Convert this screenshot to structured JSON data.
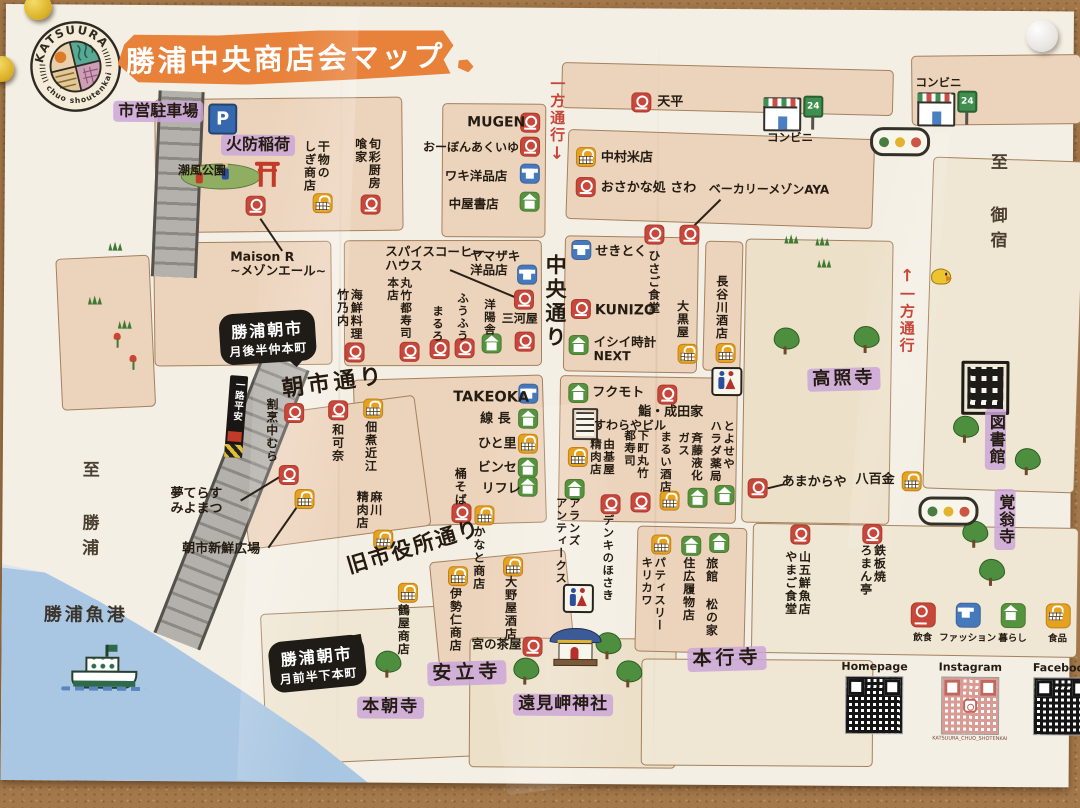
{
  "colors": {
    "red": "#c7473a",
    "blue": "#4579bd",
    "green": "#55943f",
    "yellow": "#e6a21f",
    "orange": "#e8813a",
    "purple": "#cba9d6",
    "oneway_red": "#bf3b2a"
  },
  "logo": {
    "arc_top": "KATSUURA",
    "arc_bottom": "chuo shoutenkai"
  },
  "title": "勝浦中央商店会マップ",
  "icons": {
    "parking": "P",
    "open24": "24"
  },
  "streets": [
    {
      "label": "朝市通り"
    },
    {
      "label": "旧市役所通り"
    },
    {
      "label": "中央通り"
    },
    {
      "label": "一方通行",
      "arrow": "↓"
    },
    {
      "label": "一方通行",
      "arrow": "↑"
    },
    {
      "label": "至 御宿"
    },
    {
      "label": "至 勝浦"
    },
    {
      "label": "勝浦魚港"
    },
    {
      "label": "一路平安"
    }
  ],
  "areas": [
    {
      "label": "市営駐車場"
    },
    {
      "label": "火防稲荷"
    },
    {
      "label": "潮風公園"
    },
    {
      "label": "高照寺"
    },
    {
      "label": "図書館"
    },
    {
      "label": "覚翁寺"
    },
    {
      "label": "本行寺"
    },
    {
      "label": "安立寺"
    },
    {
      "label": "本朝寺"
    },
    {
      "label": "遠見岬神社"
    }
  ],
  "bubbles": [
    {
      "lines": [
        "勝浦朝市",
        "月後半仲本町"
      ]
    },
    {
      "lines": [
        "勝浦朝市",
        "月前半下本町"
      ]
    }
  ],
  "legend": {
    "items": [
      {
        "type": "food",
        "label": "飲食"
      },
      {
        "type": "fashion",
        "label": "ファッション"
      },
      {
        "type": "living",
        "label": "暮らし"
      },
      {
        "type": "grocery",
        "label": "食品"
      }
    ]
  },
  "social": {
    "homepage": "Homepage",
    "instagram": "Instagram",
    "instagram_caption": "KATSUURA_CHUO_SHOTENKAI",
    "facebook": "Facebook"
  },
  "shops": [
    {
      "n": "干物の\nしぎ商店",
      "t": "grocery",
      "i": [
        308,
        187
      ],
      "l": [
        297,
        134
      ],
      "o": "v",
      "fs": 12
    },
    {
      "n": "旬彩厨房\n喰家",
      "t": "food",
      "i": [
        356,
        188
      ],
      "l": [
        348,
        131
      ],
      "o": "v",
      "fs": 12
    },
    {
      "n": "MUGEN",
      "t": "food",
      "i": [
        515,
        105
      ],
      "l": [
        462,
        108
      ],
      "o": "h",
      "fs": 14
    },
    {
      "n": "おーぼんあくいゆ",
      "t": "food",
      "i": [
        515,
        129
      ],
      "l": [
        418,
        134
      ],
      "o": "h",
      "fs": 12
    },
    {
      "n": "ワキ洋品店",
      "t": "fashion",
      "i": [
        515,
        156
      ],
      "l": [
        440,
        162
      ],
      "o": "h",
      "fs": 12.5
    },
    {
      "n": "中屋書店",
      "t": "living",
      "i": [
        515,
        184
      ],
      "l": [
        444,
        190
      ],
      "o": "h",
      "fs": 12.5
    },
    {
      "n": "天平",
      "t": "food",
      "i": [
        626,
        84
      ],
      "l": [
        652,
        87
      ],
      "o": "h",
      "fs": 13
    },
    {
      "n": "中村米店",
      "t": "grocery",
      "i": [
        571,
        139
      ],
      "l": [
        596,
        143
      ],
      "o": "h",
      "fs": 13
    },
    {
      "n": "おさかな処 さわ",
      "t": "food",
      "i": [
        571,
        169
      ],
      "l": [
        596,
        173
      ],
      "o": "h",
      "fs": 13
    },
    {
      "n": "コンビニ",
      "t": "store",
      "i": [
        758,
        88
      ],
      "l": [
        762,
        122
      ],
      "o": "h",
      "fs": 11.5
    },
    {
      "n": "コンビニ",
      "t": "store",
      "i": [
        912,
        82
      ],
      "l": [
        910,
        66
      ],
      "o": "h",
      "fs": 11.5
    },
    {
      "n": "せきとく",
      "t": "fashion",
      "i": [
        567,
        232
      ],
      "l": [
        591,
        237
      ],
      "o": "h",
      "fs": 13
    },
    {
      "n": "ひさご食堂",
      "t": "food",
      "i": [
        640,
        216
      ],
      "l": [
        642,
        241
      ],
      "o": "v",
      "fs": 12
    },
    {
      "n": "ベーカリーメゾンAYA",
      "t": "food",
      "i": [
        675,
        216
      ],
      "l": [
        704,
        174
      ],
      "o": "h",
      "fs": 12,
      "ln": [
        716,
        190,
        688,
        218
      ]
    },
    {
      "n": "長谷川酒店",
      "t": "grocery",
      "i": [
        712,
        334
      ],
      "l": [
        710,
        266
      ],
      "o": "v",
      "fs": 12
    },
    {
      "n": "KUNIZO",
      "t": "food",
      "i": [
        567,
        291
      ],
      "l": [
        591,
        295
      ],
      "o": "h",
      "fs": 14
    },
    {
      "n": "イシイ時計\nNEXT",
      "t": "living",
      "i": [
        565,
        327
      ],
      "l": [
        590,
        327
      ],
      "o": "h",
      "fs": 12.5
    },
    {
      "n": "大黒屋",
      "t": "grocery",
      "i": [
        674,
        335
      ],
      "l": [
        671,
        291
      ],
      "o": "v",
      "fs": 12
    },
    {
      "n": "海鮮料理\n竹乃内",
      "t": "food",
      "i": [
        341,
        336
      ],
      "l": [
        331,
        282
      ],
      "o": "v",
      "fs": 12
    },
    {
      "n": "スパイスコーヒー\nハウス",
      "t": "food",
      "i": [
        510,
        282
      ],
      "l": [
        381,
        238
      ],
      "o": "h",
      "fs": 12.5,
      "ln": [
        446,
        262,
        512,
        289
      ]
    },
    {
      "n": "ヤマザキ\n洋品店",
      "t": "fashion",
      "i": [
        513,
        257
      ],
      "l": [
        466,
        242
      ],
      "o": "h",
      "fs": 12.5
    },
    {
      "n": "丸竹都寿司\n本店",
      "t": "food",
      "i": [
        396,
        335
      ],
      "l": [
        382,
        270
      ],
      "o": "v",
      "fs": 11.5
    },
    {
      "n": "まるろ",
      "t": "food",
      "i": [
        426,
        332
      ],
      "l": [
        427,
        298
      ],
      "o": "v",
      "fs": 11.5
    },
    {
      "n": "ふうふう",
      "t": "food",
      "i": [
        451,
        331
      ],
      "l": [
        452,
        285
      ],
      "o": "v",
      "fs": 11.5
    },
    {
      "n": "洋陽舎",
      "t": "living",
      "i": [
        478,
        326
      ],
      "l": [
        479,
        291
      ],
      "o": "v",
      "fs": 11.5
    },
    {
      "n": "三河屋",
      "t": "food",
      "i": [
        511,
        324
      ],
      "l": [
        498,
        305
      ],
      "o": "h",
      "fs": 12
    },
    {
      "n": "TAKEOKA",
      "t": "fashion",
      "i": [
        515,
        376
      ],
      "l": [
        450,
        382
      ],
      "o": "h",
      "fs": 14.5
    },
    {
      "n": "線 長",
      "t": "living",
      "i": [
        515,
        401
      ],
      "l": [
        477,
        405
      ],
      "o": "h",
      "fs": 13
    },
    {
      "n": "ひと里",
      "t": "grocery",
      "i": [
        515,
        426
      ],
      "l": [
        475,
        430
      ],
      "o": "h",
      "fs": 13
    },
    {
      "n": "ビンセ",
      "t": "living",
      "i": [
        515,
        450
      ],
      "l": [
        475,
        454
      ],
      "o": "h",
      "fs": 13
    },
    {
      "n": "リフレ",
      "t": "living",
      "i": [
        515,
        469
      ],
      "l": [
        479,
        475
      ],
      "o": "h",
      "fs": 13
    },
    {
      "n": "桶そば",
      "t": "food",
      "i": [
        449,
        496
      ],
      "l": [
        450,
        460
      ],
      "o": "v",
      "fs": 12
    },
    {
      "n": "かなと商店",
      "t": "grocery",
      "i": [
        472,
        498
      ],
      "l": [
        469,
        518
      ],
      "o": "v",
      "fs": 12
    },
    {
      "n": "フクモト",
      "t": "living",
      "i": [
        565,
        375
      ],
      "l": [
        589,
        378
      ],
      "o": "h",
      "fs": 13
    },
    {
      "n": "鮨・成田家",
      "t": "food",
      "i": [
        654,
        376
      ],
      "l": [
        635,
        397
      ],
      "o": "h",
      "fs": 13
    },
    {
      "n": "すわらやビル",
      "t": "building",
      "i": [
        569,
        400
      ],
      "l": [
        591,
        411
      ],
      "o": "h",
      "fs": 12
    },
    {
      "n": "由基屋\n精肉店",
      "t": "grocery",
      "i": [
        565,
        439
      ],
      "l": [
        586,
        430
      ],
      "o": "v",
      "fs": 11.5
    },
    {
      "n": "下町丸竹\n都寿司",
      "t": "food",
      "i": [
        628,
        484
      ],
      "l": [
        620,
        421
      ],
      "o": "v",
      "fs": 11.5
    },
    {
      "n": "まるい酒店",
      "t": "grocery",
      "i": [
        657,
        482
      ],
      "l": [
        656,
        422
      ],
      "o": "v",
      "fs": 11.5
    },
    {
      "n": "斉藤液化\nガス",
      "t": "living",
      "i": [
        685,
        479
      ],
      "l": [
        674,
        423
      ],
      "o": "v",
      "fs": 11.5
    },
    {
      "n": "とよせや\nハラダ薬局",
      "t": "living",
      "i": [
        712,
        476
      ],
      "l": [
        706,
        411
      ],
      "o": "v",
      "fs": 11.5
    },
    {
      "n": "アランズ\nアンティークス",
      "t": "living",
      "i": [
        562,
        471
      ],
      "l": [
        552,
        489
      ],
      "o": "v",
      "fs": 11.5
    },
    {
      "n": "デンキのほさき",
      "t": "food",
      "i": [
        598,
        486
      ],
      "l": [
        599,
        506
      ],
      "o": "v",
      "fs": 11.5
    },
    {
      "n": "あまからや",
      "t": "food",
      "i": [
        745,
        469
      ],
      "l": [
        779,
        466
      ],
      "o": "h",
      "fs": 13,
      "ln": [
        765,
        478,
        781,
        474
      ]
    },
    {
      "n": "八百金",
      "t": "grocery",
      "i": [
        899,
        461
      ],
      "l": [
        853,
        463
      ],
      "o": "h",
      "fs": 13
    },
    {
      "n": "鉄板焼\nろまん亭",
      "t": "food",
      "i": [
        860,
        514
      ],
      "l": [
        856,
        534
      ],
      "o": "v",
      "fs": 12
    },
    {
      "n": "山五鮮魚店\nやまご食堂",
      "t": "food",
      "i": [
        788,
        515
      ],
      "l": [
        781,
        541
      ],
      "o": "v",
      "fs": 12
    },
    {
      "n": "旅館 松の家",
      "t": "living",
      "i": [
        707,
        524
      ],
      "l": [
        702,
        548
      ],
      "o": "v",
      "fs": 12
    },
    {
      "n": "住広履物店",
      "t": "living",
      "i": [
        679,
        527
      ],
      "l": [
        679,
        548
      ],
      "o": "v",
      "fs": 12
    },
    {
      "n": "パティスリー\nキリカワ",
      "t": "grocery",
      "i": [
        649,
        526
      ],
      "l": [
        638,
        548
      ],
      "o": "v",
      "fs": 11.5
    },
    {
      "n": "宮の茶屋",
      "t": "food",
      "i": [
        521,
        629
      ],
      "l": [
        470,
        630
      ],
      "o": "h",
      "fs": 12.5
    },
    {
      "n": "鶴屋商店",
      "t": "grocery",
      "i": [
        396,
        576
      ],
      "l": [
        394,
        597
      ],
      "o": "v",
      "fs": 12
    },
    {
      "n": "伊勢仁商店",
      "t": "grocery",
      "i": [
        446,
        559
      ],
      "l": [
        446,
        580
      ],
      "o": "v",
      "fs": 12
    },
    {
      "n": "大野屋酒店",
      "t": "grocery",
      "i": [
        501,
        549
      ],
      "l": [
        501,
        568
      ],
      "o": "v",
      "fs": 12
    },
    {
      "n": "割烹中むら",
      "t": "food",
      "i": [
        281,
        397
      ],
      "l": [
        261,
        392
      ],
      "o": "v",
      "fs": 12
    },
    {
      "n": "和可奈",
      "t": "food",
      "i": [
        325,
        394
      ],
      "l": [
        327,
        417
      ],
      "o": "v",
      "fs": 12
    },
    {
      "n": "佃煮近江",
      "t": "grocery",
      "i": [
        360,
        392
      ],
      "l": [
        360,
        414
      ],
      "o": "v",
      "fs": 12
    },
    {
      "n": "麻川\n精肉店",
      "t": "grocery",
      "i": [
        371,
        523
      ],
      "l": [
        352,
        484
      ],
      "o": "v",
      "fs": 12
    },
    {
      "n": "Maison R\n~メゾンエール~",
      "t": "food",
      "i": [
        241,
        190
      ],
      "l": [
        226,
        244
      ],
      "o": "h",
      "fs": 12.5,
      "ln": [
        256,
        212,
        278,
        244
      ]
    },
    {
      "n": "夢てらす\nみよまつ",
      "t": "food",
      "i": [
        276,
        459
      ],
      "l": [
        168,
        482
      ],
      "o": "h",
      "fs": 13,
      "ln": [
        238,
        494,
        277,
        470
      ]
    },
    {
      "n": "朝市新鮮広場",
      "t": "grocery",
      "i": [
        292,
        483
      ],
      "l": [
        180,
        537
      ],
      "o": "h",
      "fs": 13,
      "ln": [
        266,
        541,
        295,
        499
      ]
    }
  ],
  "features": [
    {
      "t": "parking",
      "p": [
        203,
        98
      ]
    },
    {
      "t": "torii",
      "p": [
        251,
        156
      ]
    },
    {
      "t": "park",
      "p": [
        176,
        158
      ]
    },
    {
      "t": "traffic",
      "p": [
        865,
        117
      ]
    },
    {
      "t": "traffic",
      "p": [
        916,
        486
      ]
    },
    {
      "t": "bird",
      "p": [
        927,
        258
      ]
    },
    {
      "t": "toilet",
      "p": [
        708,
        358
      ]
    },
    {
      "t": "toilet",
      "p": [
        561,
        576
      ]
    },
    {
      "t": "library",
      "p": [
        958,
        350
      ]
    },
    {
      "t": "shrine",
      "p": [
        548,
        620
      ]
    },
    {
      "t": "boat",
      "p": [
        66,
        640
      ]
    }
  ],
  "nature": {
    "trees": [
      [
        770,
        318
      ],
      [
        850,
        316
      ],
      [
        950,
        405
      ],
      [
        1012,
        437
      ],
      [
        960,
        510
      ],
      [
        977,
        548
      ],
      [
        512,
        650
      ],
      [
        594,
        624
      ],
      [
        615,
        652
      ],
      [
        374,
        644
      ]
    ],
    "grass": [
      [
        104,
        236
      ],
      [
        84,
        290
      ],
      [
        114,
        314
      ],
      [
        780,
        224
      ],
      [
        811,
        226
      ],
      [
        813,
        248
      ]
    ],
    "flowers": [
      [
        110,
        328
      ],
      [
        126,
        350
      ]
    ]
  }
}
